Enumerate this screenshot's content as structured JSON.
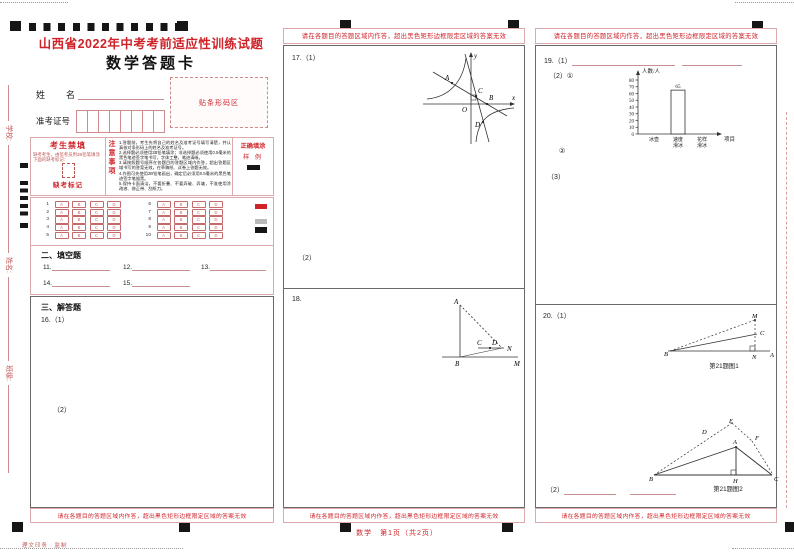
{
  "colors": {
    "accent_red": "#cf2329",
    "border_pink": "#dcaaaa",
    "bubble_red": "#c46a6a",
    "mark_black": "#161616",
    "mark_gray": "#b9b9b9"
  },
  "page": {
    "title": "山西省2022年中考考前适应性训练试题",
    "subtitle": "数学答题卡",
    "warning": "请在各题目的答题区域内作答，超出黑色矩形边框限定区域的答案无效",
    "footer_center": "数学　第1页（共2页）",
    "footer_left": "理文印务　监制"
  },
  "edge": {
    "labels": [
      "学校:",
      "姓名:",
      "班级:"
    ]
  },
  "student_info": {
    "name_label": "姓　　名",
    "exam_no_label": "准考证号",
    "exam_no_cells": 8,
    "barcode_label": "贴条形码区"
  },
  "notice": {
    "forbid_title": "考生禁填",
    "forbid_text": "缺考考生，由监考员用2B铅笔填涂下面的缺考标记：",
    "absent_label": "缺考标记",
    "attention_title": "注意事项",
    "items": [
      "1.答题前，考生先将自己的姓名及准考证号填写清楚，并认真核对条形码上的姓名及准考证号。",
      "2.选择题必须使用2B铅笔填涂；非选择题必须使用0.5毫米的黑色笔迹签字笔书写，字体工整，笔迹清晰。",
      "3.请按照题号顺序在各题目的答题区域内作答，超出答题区域书写的答案无效，在草稿纸、试卷上答题无效。",
      "4.作图可先使用2B铅笔画出，确定后必须用0.5毫米的黑色笔迹签字笔描黑。",
      "5.保持卡面清洁，不要折叠、不要弄破、弄皱，不准使用涂改液、修正带、刮纸刀。"
    ],
    "correct_fill_title": "正确填涂",
    "sample_label": "样 例"
  },
  "choices": {
    "options": [
      "A",
      "B",
      "C",
      "D"
    ],
    "group1": [
      "1",
      "2",
      "3",
      "4",
      "5"
    ],
    "group2": [
      "6",
      "7",
      "8",
      "9",
      "10"
    ]
  },
  "sections": {
    "fill_title": "二、填空题",
    "fill_numbers": [
      "11.",
      "12.",
      "13.",
      "14.",
      "15."
    ],
    "answer_title": "三、解答题"
  },
  "questions": {
    "q16": {
      "label": "16.（1）",
      "part2": "（2）"
    },
    "q17": {
      "label": "17.（1）",
      "part2": "（2）"
    },
    "q18": {
      "label": "18."
    },
    "q19": {
      "label": "19.（1）",
      "part2": "（2）①",
      "part2b": "②",
      "part3": "（3）"
    },
    "q20": {
      "label": "20.（1）",
      "part2": "（2）",
      "fig1_caption": "第21题图1",
      "fig2_caption": "第21题图2"
    }
  },
  "figures": {
    "q17": {
      "axis_y": "y",
      "axis_x": "x",
      "pA": "A",
      "pB": "B",
      "pC": "C",
      "pD": "D",
      "origin": "O"
    },
    "q18": {
      "pA": "A",
      "pB": "B",
      "pC": "C",
      "pD": "D",
      "pM": "M",
      "pN": "N"
    },
    "q20f1": {
      "pB": "B",
      "pM": "M",
      "pC": "C",
      "pN": "N",
      "pA": "A"
    },
    "q20f2": {
      "pB": "B",
      "pC": "C",
      "pA": "A",
      "pH": "H",
      "pD": "D",
      "pE": "E",
      "pF": "F"
    }
  },
  "chart_data": {
    "type": "bar",
    "ylabel": "人数/人",
    "xlabel": "项目",
    "categories": [
      "冰壶",
      "速度滑冰",
      "花样滑冰"
    ],
    "values": [
      null,
      65,
      null
    ],
    "ylim": [
      0,
      80
    ],
    "yticks": [
      0,
      10,
      20,
      30,
      40,
      50,
      60,
      70,
      80
    ],
    "grid": false,
    "legend": "none",
    "note": "只绘出一个条形：速度滑冰 65 人，其余条形待考生补全"
  }
}
